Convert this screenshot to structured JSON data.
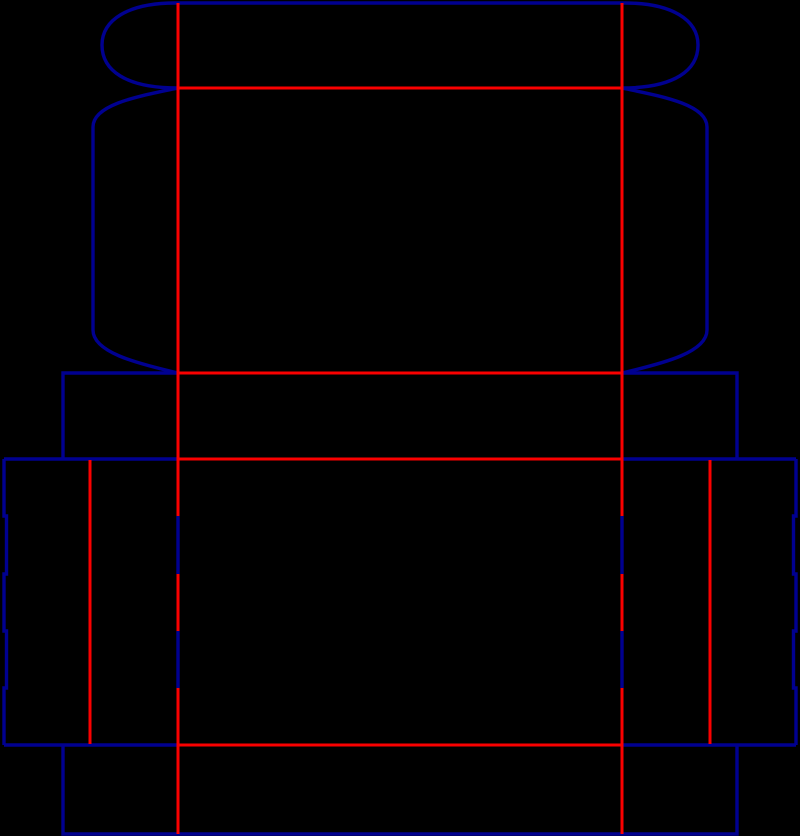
{
  "diagram": {
    "type": "packaging-dieline",
    "description": "box dieline with cut lines and crease lines",
    "canvas": {
      "width": 800,
      "height": 836,
      "background": "#000000"
    },
    "line_styles": {
      "cut": {
        "color": "#000090",
        "width": 3.4,
        "meaning": "cut line"
      },
      "crease": {
        "color": "#FA0000",
        "width": 3.0,
        "meaning": "crease fold line"
      }
    },
    "cut_paths": [
      {
        "name": "tuck-flap-outline",
        "d": "M 178,88 C 125,88 102,70 102,45 C 102,20 128,3 175,3 L 625,3 C 672,3 698,20 698,45 C 698,70 675,88 622,88"
      },
      {
        "name": "lid-left-dust-flap",
        "d": "M 178,88 C 140,96 93,104 93,127 L 93,330 C 93,352 135,363 178,373"
      },
      {
        "name": "lid-right-dust-flap",
        "d": "M 622,88 C 660,96 707,104 707,127 L 707,330 C 707,352 665,363 622,373"
      },
      {
        "name": "left-tab-outline",
        "d": "M 178,373 L 63,373 L 63,459"
      },
      {
        "name": "right-tab-outline",
        "d": "M 622,373 L 737,373 L 737,459"
      },
      {
        "name": "left-flaps-top-edge",
        "d": "M 4,459 L 178,459"
      },
      {
        "name": "right-flaps-top-edge",
        "d": "M 622,459 L 796,459"
      },
      {
        "name": "left-serrated-edge",
        "d": "M 4,459 L 4,516 L 6.5,516 L 6.5,574 L 4,574 L 4,631 L 6.5,631 L 6.5,688 L 4,688 L 4,745"
      },
      {
        "name": "right-serrated-edge",
        "d": "M 796,459 L 796,516 L 793.5,516 L 793.5,574 L 796,574 L 796,631 L 793.5,631 L 793.5,688 L 796,688 L 796,745"
      },
      {
        "name": "left-flaps-bottom-edge",
        "d": "M 4,745 L 178,745"
      },
      {
        "name": "right-flaps-bottom-edge",
        "d": "M 622,745 L 796,745"
      },
      {
        "name": "bottom-band-outline",
        "d": "M 63,745 L 63,834 L 737,834 L 737,745"
      },
      {
        "name": "left-fold-slit-upper",
        "d": "M 178,516 L 178,574"
      },
      {
        "name": "left-fold-slit-lower",
        "d": "M 178,631 L 178,688"
      },
      {
        "name": "right-fold-slit-upper",
        "d": "M 622,516 L 622,574"
      },
      {
        "name": "right-fold-slit-lower",
        "d": "M 622,631 L 622,688"
      }
    ],
    "crease_lines": [
      {
        "name": "left-main-fold-top",
        "x1": 178,
        "y1": 3,
        "x2": 178,
        "y2": 516
      },
      {
        "name": "left-main-fold-mid",
        "x1": 178,
        "y1": 574,
        "x2": 178,
        "y2": 631
      },
      {
        "name": "left-main-fold-bottom",
        "x1": 178,
        "y1": 688,
        "x2": 178,
        "y2": 834
      },
      {
        "name": "right-main-fold-top",
        "x1": 622,
        "y1": 3,
        "x2": 622,
        "y2": 516
      },
      {
        "name": "right-main-fold-mid",
        "x1": 622,
        "y1": 574,
        "x2": 622,
        "y2": 631
      },
      {
        "name": "right-main-fold-bottom",
        "x1": 622,
        "y1": 688,
        "x2": 622,
        "y2": 834
      },
      {
        "name": "left-dust-flap-fold",
        "x1": 90,
        "y1": 460,
        "x2": 90,
        "y2": 744
      },
      {
        "name": "right-dust-flap-fold",
        "x1": 710,
        "y1": 460,
        "x2": 710,
        "y2": 744
      },
      {
        "name": "tuck-flap-fold",
        "x1": 178,
        "y1": 88,
        "x2": 622,
        "y2": 88
      },
      {
        "name": "lid-panel-fold",
        "x1": 178,
        "y1": 373,
        "x2": 622,
        "y2": 373
      },
      {
        "name": "band-fold",
        "x1": 178,
        "y1": 459,
        "x2": 622,
        "y2": 459
      },
      {
        "name": "bottom-band-fold",
        "x1": 178,
        "y1": 745,
        "x2": 622,
        "y2": 745
      }
    ]
  }
}
